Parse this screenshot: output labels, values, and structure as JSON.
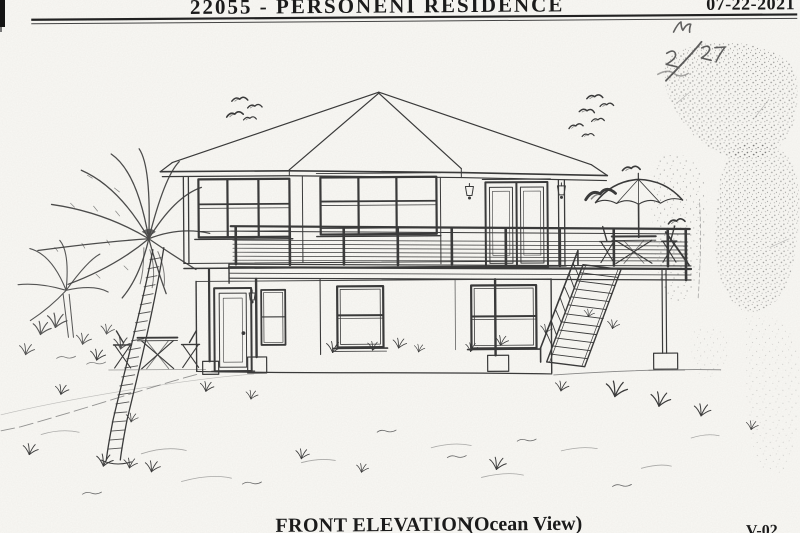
{
  "header": {
    "title": "22055 - PERSONENI RESIDENCE",
    "date": "07-22-2021"
  },
  "footer": {
    "title": "FRONT ELEVATION",
    "subtitle": "(Ocean View)",
    "sheet_label": "V-02"
  },
  "annotations": {
    "handwritten_note": "M 2/27"
  },
  "drawing": {
    "subject": "two-story beach house front elevation",
    "features": [
      "hip-roof",
      "upper-deck-cable-railing",
      "exterior-stairs",
      "patio-umbrella",
      "french-doors",
      "palm-tree",
      "bistro-set",
      "birds",
      "foliage"
    ]
  },
  "colors": {
    "paper": "#fbfaf6",
    "ink": "#3a3a3a",
    "title_ink": "#1b1b1b"
  }
}
